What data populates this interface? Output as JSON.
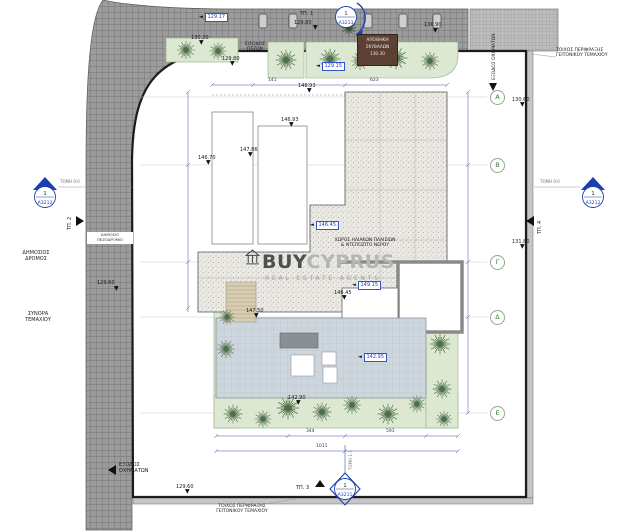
{
  "watermark": {
    "brand_bold": "BUY",
    "brand_light": "CYPRUS",
    "tagline": "REAL ESTATE AGENTS"
  },
  "labels": {
    "pedestrian_entrance": "ΕΙΣΟΔΟΣ\nΠΕΖΩΝ",
    "vehicle_exit_right": "ΕΞΟΔΟΣ\nΟΧΗΜΑΤΩΝ",
    "vehicle_exit_bottom": "ΕΞΟΔΟΣ\nΟΧΗΜΑΤΩΝ",
    "fence_wall_right": "ΤΟΙΧΟΣ ΠΕΡΙΦΡΑΞΗΣ\nΓΕΙΤΟΝΙΚΟΥ ΤΕΜΑΧΙΟΥ",
    "fence_wall_bottom": "ΤΟΙΧΟΣ ΠΕΡΙΦΡΑΞΗΣ\nΓΕΙΤΟΝΙΚΟΥ ΤΕΜΑΧΙΟΥ",
    "public_road": "ΔΗΜΟΣΙΟΣ\nΔΡΟΜΟΣ",
    "public_sidewalk": "ΔΗΜΟΣΙΟ\nΠΕΖΟΔΡΟΜΙΟ",
    "plot_boundary": "ΣΥΝΟΡΑ\nΤΕΜΑΧΙΟΥ",
    "solar_area": "ΧΩΡΟΣ ΗΛΙΑΚΩΝ ΠΛΑΙΣΙΩΝ\n& ΝΤΕΠΟΖΙΤΟ ΝΕΡΟΥ",
    "section_left": "ΤΟΜΗ 0-0",
    "section_right": "ΤΟΜΗ 0-0",
    "section_bottom": "ΤΟΜΗ 1-1",
    "tp1": "ΤΠ. 1",
    "tp2": "ΤΠ. 2",
    "tp3": "ΤΠ. 3",
    "tp4": "ΤΠ. 4"
  },
  "storage_room": {
    "line1": "ΑΠΟΘΗΚΗ",
    "line2": "ΣΚΥΒΑΛΩΝ",
    "level": "130.30"
  },
  "section_markers": {
    "top": {
      "num": "1",
      "sheet": "A3213"
    },
    "left": {
      "num": "1",
      "sheet": "A3212"
    },
    "right": {
      "num": "1",
      "sheet": "A3212"
    },
    "bottom": {
      "num": "1",
      "sheet": "A3211"
    }
  },
  "colors": {
    "marker_blue": "#1d3fae",
    "level_blue": "#2244bb",
    "garden_green": "#dce8d2",
    "deck_blue_gray": "#cdd5dd",
    "road_gray": "#9c9c9c",
    "storage_brown": "#5c4033"
  },
  "annotations": {
    "boxed_levels": [
      {
        "t": "129.17",
        "x": 205,
        "y": 13
      },
      {
        "t": "129.15",
        "x": 322,
        "y": 62
      },
      {
        "t": "146.45",
        "x": 316,
        "y": 221
      },
      {
        "t": "149.15",
        "x": 358,
        "y": 281
      },
      {
        "t": "142.95",
        "x": 364,
        "y": 353
      }
    ],
    "spot_levels": [
      {
        "t": "130.20",
        "x": 191,
        "y": 35,
        "tx": 202,
        "ty": 42
      },
      {
        "t": "129.80",
        "x": 222,
        "y": 56,
        "tx": 233,
        "ty": 63
      },
      {
        "t": "129.80",
        "x": 294,
        "y": 20,
        "tx": 316,
        "ty": 27
      },
      {
        "t": "136.90",
        "x": 424,
        "y": 22,
        "tx": 436,
        "ty": 30
      },
      {
        "t": "130.60",
        "x": 512,
        "y": 97,
        "tx": 523,
        "ty": 104
      },
      {
        "t": "131.80",
        "x": 512,
        "y": 239,
        "tx": 523,
        "ty": 246
      },
      {
        "t": "129.60",
        "x": 97,
        "y": 280,
        "tx": 117,
        "ty": 288
      },
      {
        "t": "146.93",
        "x": 298,
        "y": 83,
        "tx": 310,
        "ty": 90
      },
      {
        "t": "146.93",
        "x": 281,
        "y": 117,
        "tx": 292,
        "ty": 124
      },
      {
        "t": "147.86",
        "x": 240,
        "y": 147,
        "tx": 251,
        "ty": 154
      },
      {
        "t": "146.70",
        "x": 198,
        "y": 155,
        "tx": 209,
        "ty": 162
      },
      {
        "t": "146.45",
        "x": 334,
        "y": 290,
        "tx": 345,
        "ty": 297
      },
      {
        "t": "147.50",
        "x": 246,
        "y": 308,
        "tx": 257,
        "ty": 315
      },
      {
        "t": "142.90",
        "x": 288,
        "y": 395,
        "tx": 299,
        "ty": 402
      },
      {
        "t": "129.60",
        "x": 176,
        "y": 484,
        "tx": 188,
        "ty": 491
      }
    ],
    "dims": [
      {
        "t": "141",
        "x": 268,
        "y": 78
      },
      {
        "t": "623",
        "x": 370,
        "y": 78
      },
      {
        "t": "344",
        "x": 306,
        "y": 429
      },
      {
        "t": "593",
        "x": 386,
        "y": 429
      },
      {
        "t": "1011",
        "x": 316,
        "y": 444
      }
    ],
    "grid_rows": [
      {
        "letter": "Α",
        "y": 97
      },
      {
        "letter": "Β",
        "y": 165
      },
      {
        "letter": "Γ",
        "y": 262
      },
      {
        "letter": "Δ",
        "y": 317
      },
      {
        "letter": "Ε",
        "y": 413
      }
    ]
  }
}
